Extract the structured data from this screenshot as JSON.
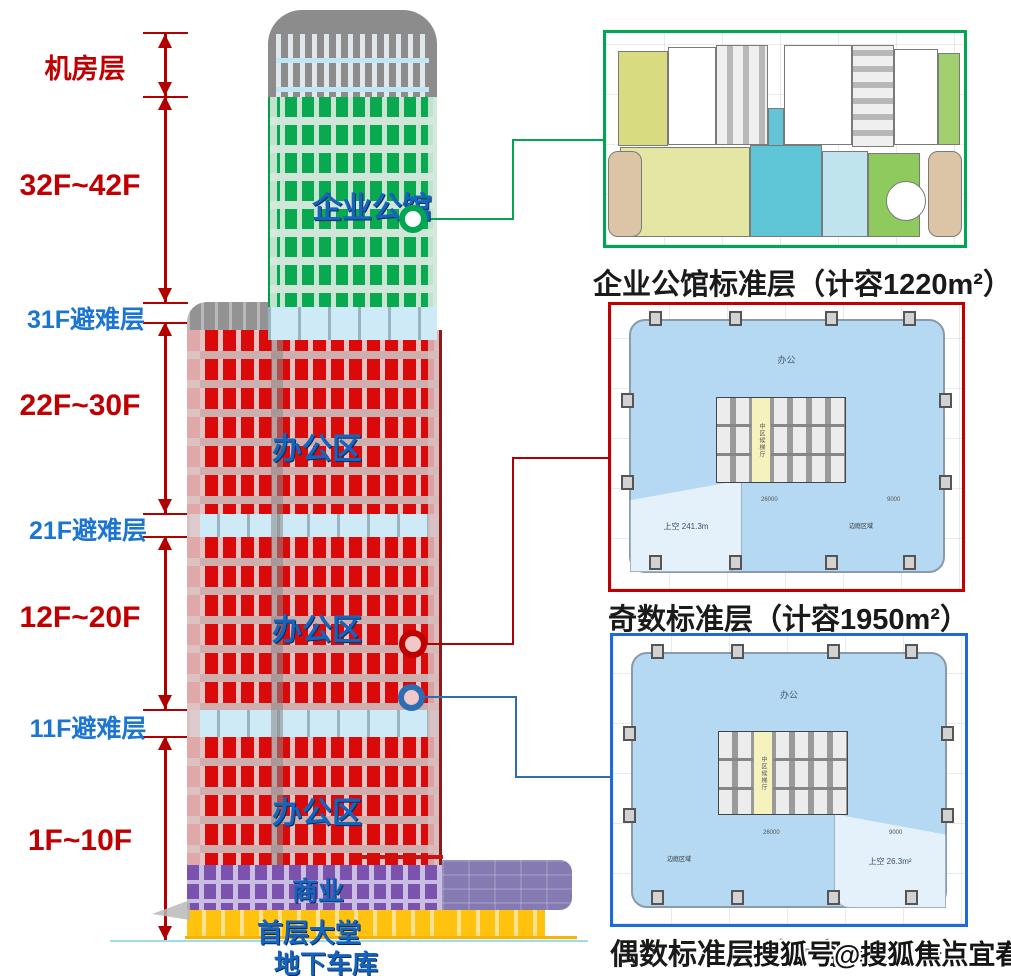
{
  "left": {
    "machine": "机房层",
    "f32": "32F~42F",
    "r31": "31F避难层",
    "f22": "22F~30F",
    "r21": "21F避难层",
    "f12": "12F~20F",
    "r11": "11F避难层",
    "f1": "1F~10F"
  },
  "tower": {
    "mansion": "企业公馆",
    "office_top": "办公区",
    "office_mid": "办公区",
    "office_low": "办公区",
    "commercial": "商业",
    "lobby": "首层大堂",
    "garage": "地下车库"
  },
  "plans": {
    "p1": {
      "caption": "企业公馆标准层（计容1220m²）"
    },
    "p2": {
      "caption": "奇数标准层（计容1950m²）",
      "office": "办公",
      "void": "上空 241.3m",
      "core": "中区候梯厅",
      "side": "边庭区域",
      "dim_a": "26000",
      "dim_b": "9000"
    },
    "p3": {
      "caption": "偶数标准层（计容1950m²）",
      "office": "办公",
      "void": "上空 26.3m²",
      "core": "中区候梯厅",
      "side": "边庭区域",
      "dim_a": "26000",
      "dim_b": "9000"
    }
  },
  "watermark": "搜狐号@搜狐焦点宜春站",
  "colors": {
    "accent_green": "#00A651",
    "accent_red": "#C00000",
    "accent_blue": "#1E6AD6",
    "label_blue": "#1565C0",
    "refuge_cyan": "#CDEAF6",
    "window_red": "#DB0A0A",
    "window_green": "#09A94F",
    "podium_purple": "#857BB2",
    "lobby_yellow": "#FFC20E"
  }
}
